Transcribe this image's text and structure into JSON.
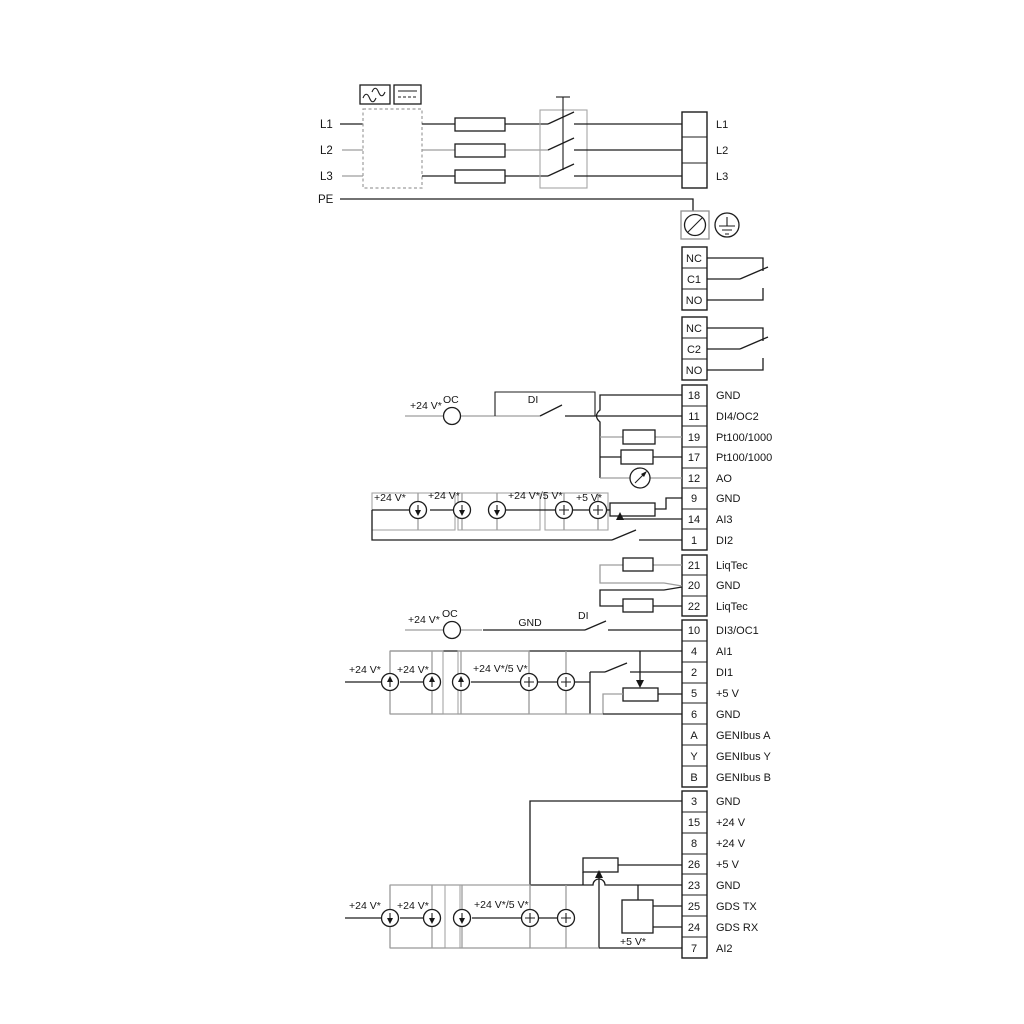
{
  "diagram_title": "Pump drive wiring diagram",
  "power": {
    "l1": "L1",
    "l2": "L2",
    "l3": "L3",
    "pe": "PE"
  },
  "terminals": {
    "mains": {
      "labels": [
        "L1",
        "L2",
        "L3"
      ]
    },
    "relay1": {
      "cells": [
        "NC",
        "C1",
        "NO"
      ]
    },
    "relay2": {
      "cells": [
        "NC",
        "C2",
        "NO"
      ]
    },
    "io1": {
      "rows": [
        {
          "id": "18",
          "label": "GND"
        },
        {
          "id": "11",
          "label": "DI4/OC2"
        },
        {
          "id": "19",
          "label": "Pt100/1000"
        },
        {
          "id": "17",
          "label": "Pt100/1000"
        },
        {
          "id": "12",
          "label": "AO"
        },
        {
          "id": "9",
          "label": "GND"
        },
        {
          "id": "14",
          "label": "AI3"
        },
        {
          "id": "1",
          "label": "DI2"
        }
      ]
    },
    "liqtec": {
      "rows": [
        {
          "id": "21",
          "label": "LiqTec"
        },
        {
          "id": "20",
          "label": "GND"
        },
        {
          "id": "22",
          "label": "LiqTec"
        }
      ]
    },
    "io2": {
      "rows": [
        {
          "id": "10",
          "label": "DI3/OC1"
        },
        {
          "id": "4",
          "label": "AI1"
        },
        {
          "id": "2",
          "label": "DI1"
        },
        {
          "id": "5",
          "label": "+5 V"
        },
        {
          "id": "6",
          "label": "GND"
        },
        {
          "id": "A",
          "label": "GENIbus A"
        },
        {
          "id": "Y",
          "label": "GENIbus Y"
        },
        {
          "id": "B",
          "label": "GENIbus B"
        }
      ]
    },
    "io3": {
      "rows": [
        {
          "id": "3",
          "label": "GND"
        },
        {
          "id": "15",
          "label": "+24 V"
        },
        {
          "id": "8",
          "label": "+24 V"
        },
        {
          "id": "26",
          "label": "+5 V"
        },
        {
          "id": "23",
          "label": "GND"
        },
        {
          "id": "25",
          "label": "GDS TX"
        },
        {
          "id": "24",
          "label": "GDS RX"
        },
        {
          "id": "7",
          "label": "AI2"
        }
      ]
    }
  },
  "ann": {
    "v24": "+24 V*",
    "v24or5": "+24 V*/5 V*",
    "v5": "+5 V*",
    "oc": "OC",
    "di": "DI",
    "gnd": "GND"
  },
  "colors": {
    "wire": "#1d1d1d",
    "wire_gray": "#9d9d9d",
    "background": "#ffffff"
  }
}
